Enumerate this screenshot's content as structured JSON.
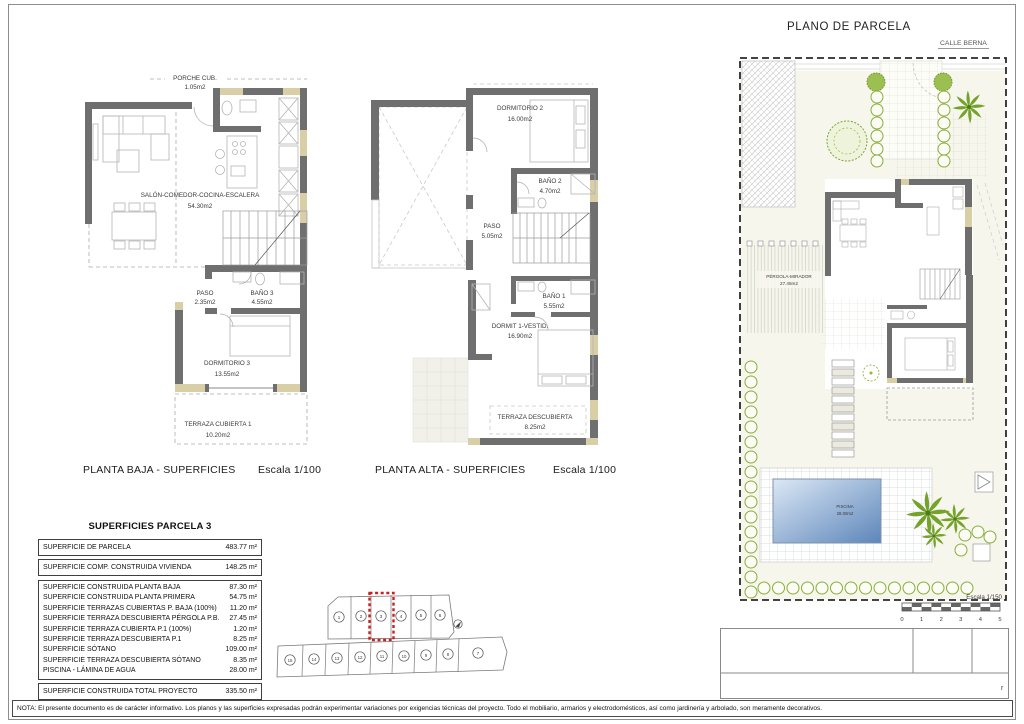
{
  "page": {
    "title": "PLANO DE PARCELA",
    "footer_note": "NOTA: El presente documento es de carácter informativo. Los planos y las superficies expresadas podrán experimentar variaciones por exigencias técnicas del proyecto. Todo el mobiliario, armarios y electrodomésticos, así como jardinería y arbolado, son meramente decorativos."
  },
  "colors": {
    "wall_gray": "#6f6f6f",
    "accent_beige": "#d9cfa6",
    "vegetation_green": "#8aad3c",
    "pool_blue": "#5d86ba",
    "highlight_red": "#c92121"
  },
  "planta_baja": {
    "caption": "PLANTA BAJA - SUPERFICIES",
    "scale": "Escala 1/100",
    "rooms": {
      "porche": {
        "name": "PORCHE CUB.",
        "area": "1.05m2"
      },
      "salon": {
        "name": "SALÓN-COMEDOR-COCINA-ESCALERA",
        "area": "54.30m2"
      },
      "paso": {
        "name": "PASO",
        "area": "2.35m2"
      },
      "bano3": {
        "name": "BAÑO 3",
        "area": "4.55m2"
      },
      "dormitorio3": {
        "name": "DORMITORIO 3",
        "area": "13.55m2"
      },
      "terraza": {
        "name": "TERRAZA CUBIERTA 1",
        "area": "10.20m2"
      }
    }
  },
  "planta_alta": {
    "caption": "PLANTA ALTA - SUPERFICIES",
    "scale": "Escala 1/100",
    "rooms": {
      "dormitorio2": {
        "name": "DORMITORIO 2",
        "area": "16.00m2"
      },
      "bano2": {
        "name": "BAÑO 2",
        "area": "4.70m2"
      },
      "paso": {
        "name": "PASO",
        "area": "5.05m2"
      },
      "bano1": {
        "name": "BAÑO 1",
        "area": "5.55m2"
      },
      "dormit1": {
        "name": "DORMIT 1-VESTID.",
        "area": "16.90m2"
      },
      "terraza": {
        "name": "TERRAZA DESCUBIERTA",
        "area": "8.25m2"
      }
    }
  },
  "parcela": {
    "street": "CALLE BERNA",
    "pergola": {
      "name": "PÉRGOLA-MIRADOR",
      "area": "27.45m2"
    },
    "piscina": {
      "name": "PISCINA",
      "area": "28.00m2"
    },
    "scalebar": {
      "label": "Escala 1/150",
      "ticks": [
        "0",
        "1",
        "2",
        "3",
        "4",
        "5"
      ]
    }
  },
  "surfaces_table": {
    "title": "SUPERFICIES PARCELA 3",
    "top_rows": [
      {
        "label": "SUPERFICIE DE PARCELA",
        "value": "483.77 m²"
      },
      {
        "label": "SUPERFICIE COMP. CONSTRUIDA VIVIENDA",
        "value": "148.25 m²"
      }
    ],
    "mid_rows": [
      {
        "label": "SUPERFICIE CONSTRUIDA PLANTA BAJA",
        "value": "87.30 m²"
      },
      {
        "label": "SUPERFICIE CONSTRUIDA PLANTA PRIMERA",
        "value": "54.75 m²"
      },
      {
        "label": "SUPERFICIE TERRAZAS CUBIERTAS P. BAJA (100%)",
        "value": "11.20 m²"
      },
      {
        "label": "SUPERFICIE TERRAZA DESCUBIERTA PÉRGOLA P.B.",
        "value": "27.45 m²"
      },
      {
        "label": "SUPERFICIE TERRAZA CUBIERTA P.1 (100%)",
        "value": "1.20 m²"
      },
      {
        "label": "SUPERFICIE TERRAZA DESCUBIERTA P.1",
        "value": "8.25 m²"
      },
      {
        "label": "SUPERFICIE SÓTANO",
        "value": "109.00 m²"
      },
      {
        "label": "SUPERFICIE TERRAZA DESCUBIERTA SÓTANO",
        "value": "8.35 m²"
      },
      {
        "label": "PISCINA - LÁMINA DE AGUA",
        "value": "28.00 m²"
      }
    ],
    "total_row": {
      "label": "SUPERFICIE CONSTRUIDA TOTAL PROYECTO",
      "value": "335.50 m²"
    }
  },
  "parcel_map": {
    "top_row": [
      "1",
      "2",
      "3",
      "4",
      "5",
      "6"
    ],
    "bottom_row": [
      "15",
      "14",
      "13",
      "12",
      "11",
      "10",
      "9",
      "8",
      "7"
    ],
    "highlighted_plot": "3"
  },
  "titleblock": {
    "mark": "r"
  }
}
